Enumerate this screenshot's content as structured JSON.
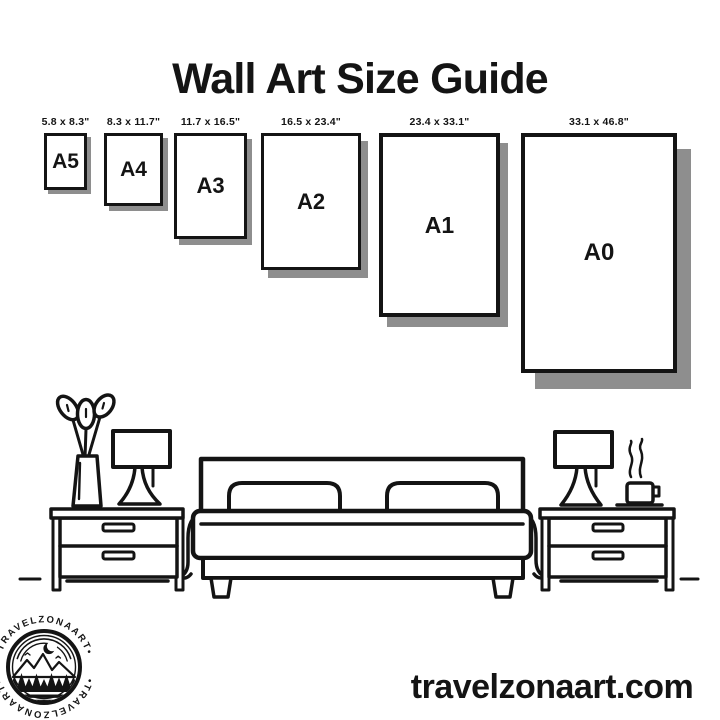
{
  "colors": {
    "background": "#ffffff",
    "ink": "#141414",
    "shadow": "#8e8e8e"
  },
  "title": "Wall Art Size Guide",
  "size_guide": {
    "sizes": [
      {
        "code": "A5",
        "dimensions": "5.8 x 8.3\""
      },
      {
        "code": "A4",
        "dimensions": "8.3 x 11.7\""
      },
      {
        "code": "A3",
        "dimensions": "11.7 x 16.5\""
      },
      {
        "code": "A2",
        "dimensions": "16.5 x 23.4\""
      },
      {
        "code": "A1",
        "dimensions": "23.4 x 33.1\""
      },
      {
        "code": "A0",
        "dimensions": "33.1 x 46.8\""
      }
    ]
  },
  "illustration": {
    "name": "bedroom-line-art",
    "elements": [
      "plant-in-vase",
      "table-lamp-left",
      "nightstand-left",
      "double-bed-with-pillows",
      "nightstand-right",
      "table-lamp-right",
      "steaming-coffee-cup",
      "floor-line"
    ]
  },
  "logo": {
    "ring_text_top": "•TRAVELZONAART•",
    "ring_text_bottom": "•TRAVELZONAART•"
  },
  "footer": {
    "website": "travelzonaart.com"
  }
}
